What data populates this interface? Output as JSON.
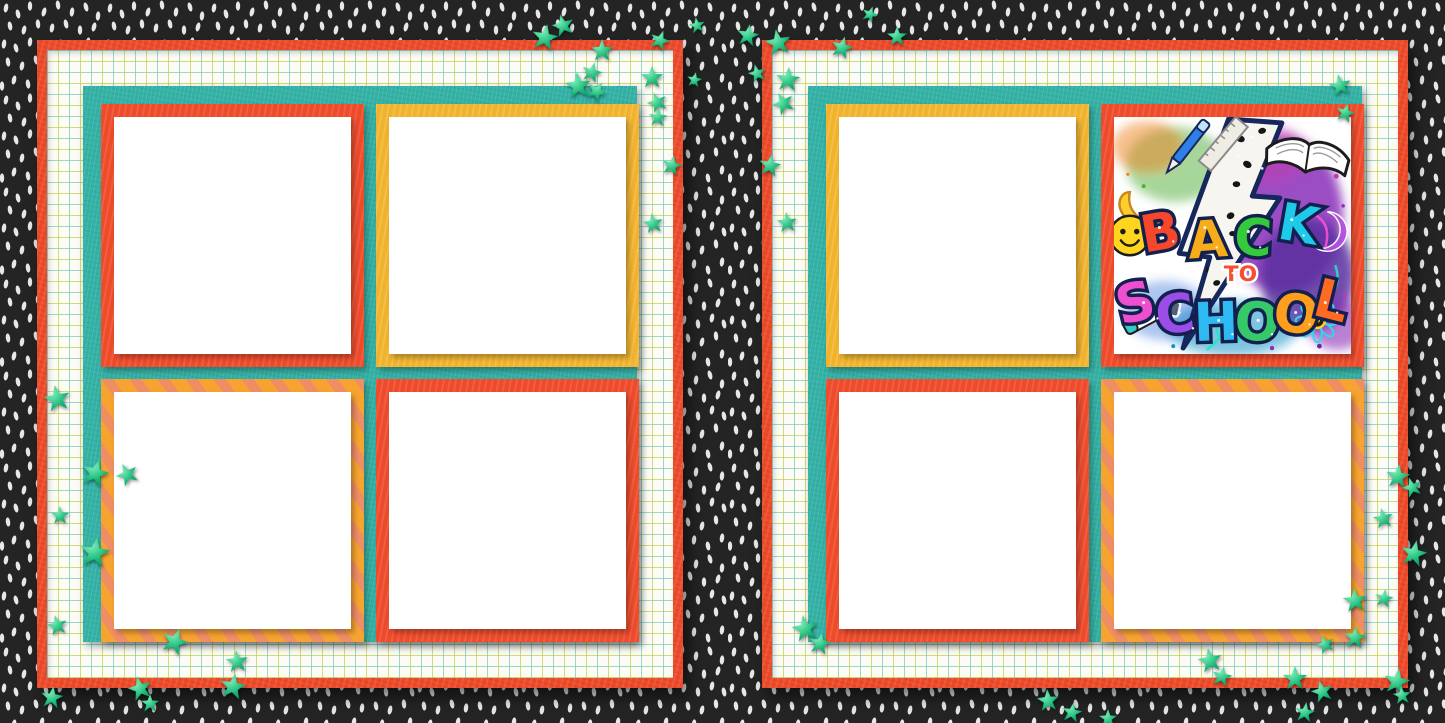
{
  "artwork": {
    "word_back_letters": [
      "B",
      "A",
      "C",
      "K"
    ],
    "word_to": "TO",
    "word_school_letters": [
      "S",
      "C",
      "H",
      "O",
      "O",
      "L"
    ],
    "letter_colors_back": [
      "#f4472b",
      "#f7ac19",
      "#35c93c",
      "#1fc9e8"
    ],
    "letter_colors_school": [
      "#ee4fd0",
      "#9b4de8",
      "#2fb9f2",
      "#35c96a",
      "#ff9e1c",
      "#ff6a21"
    ]
  },
  "palette": {
    "background_black": "#242424",
    "background_dash": "#f4f4f4",
    "page_border_red": "#ee4b2b",
    "grid_paper": "#fcfcf5",
    "grid_line_teal": "#7ac9c2",
    "grid_line_green": "#bfcd48",
    "mat_teal": "#35b2a6",
    "frame_red": "#ee4b2b",
    "frame_yellow": "#f2b32c",
    "frame_stripe_orange": "#f6a331",
    "frame_stripe_salmon": "#ef8e63",
    "photo_white": "#ffffff",
    "star_green": "#17b877"
  },
  "pages": [
    {
      "side": "left",
      "frames": [
        {
          "variant": "red"
        },
        {
          "variant": "yellow"
        },
        {
          "variant": "striped"
        },
        {
          "variant": "red"
        }
      ]
    },
    {
      "side": "right",
      "frames": [
        {
          "variant": "yellow"
        },
        {
          "variant": "art"
        },
        {
          "variant": "red"
        },
        {
          "variant": "striped"
        }
      ]
    }
  ]
}
